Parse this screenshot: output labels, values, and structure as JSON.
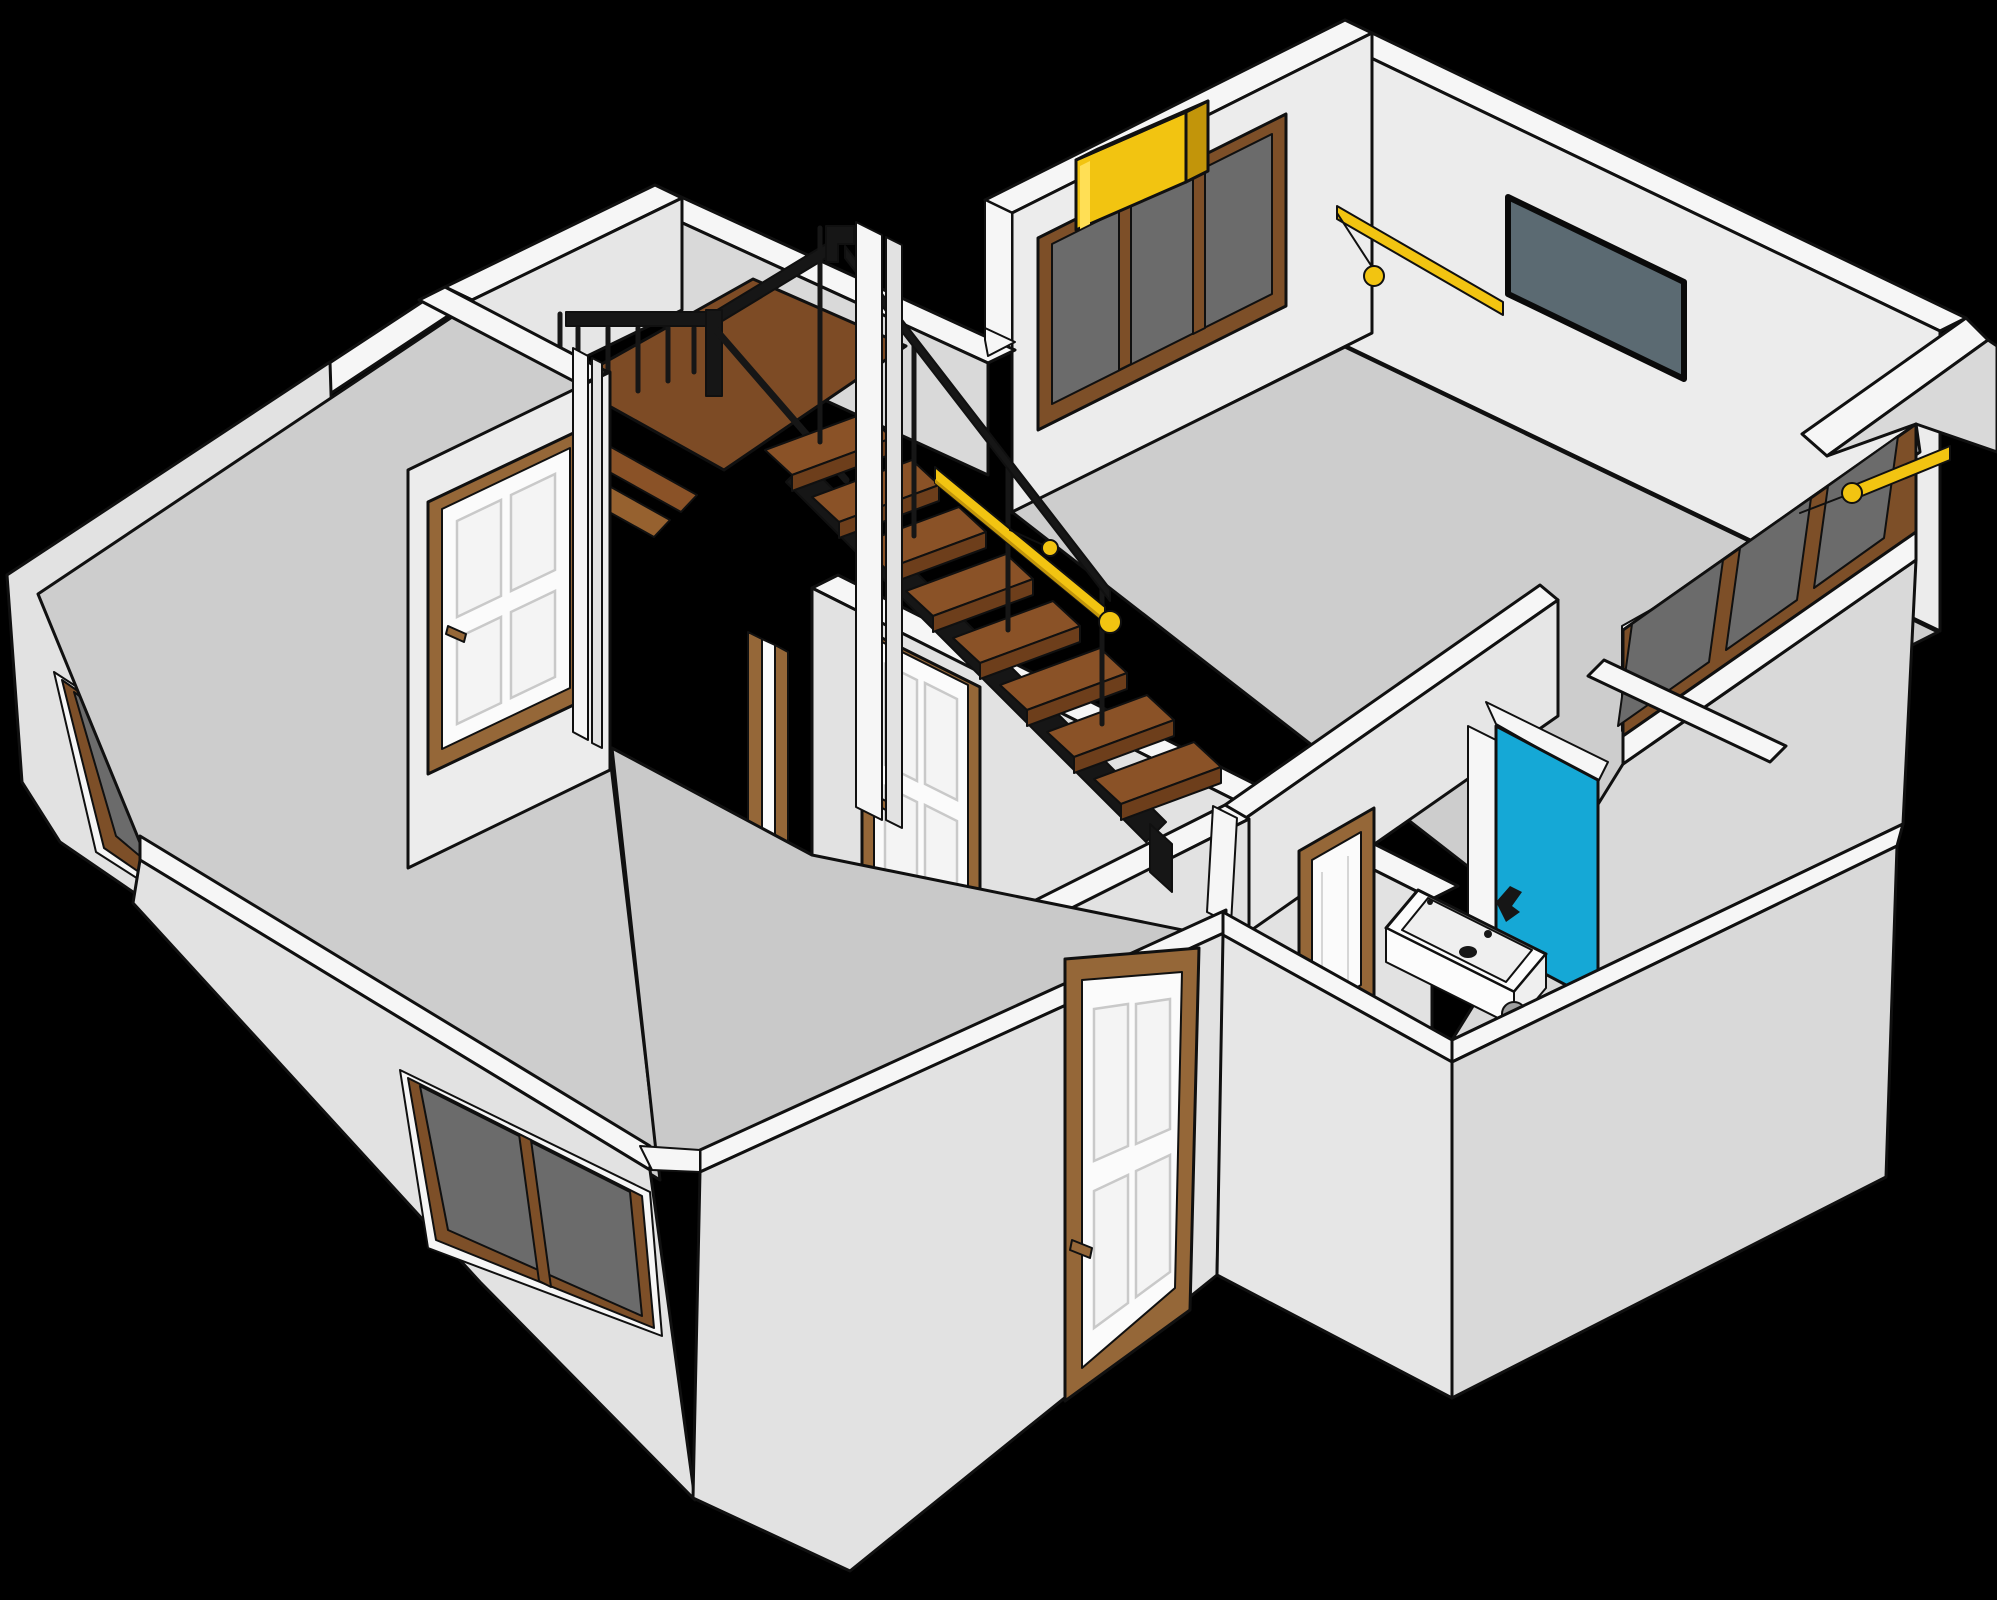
{
  "scene": {
    "title": "Isometric 3D cutaway floor plan of a single-storey house interior on a black background",
    "type": "vector-illustration",
    "background": "#000000"
  },
  "palette": {
    "wall_top": "#f6f6f6",
    "wall_face_light": "#ececec",
    "wall_face_mid": "#e2e2e2",
    "wall_face_dark": "#d9d9d9",
    "floor": "#cdcdcd",
    "outline": "#101010",
    "wood_landing": "#7d4b25",
    "wood_tread": "#8a5227",
    "wood_dark": "#6d3e1b",
    "door_frame_brown": "#956738",
    "door_leaf_white": "#fbfbfb",
    "window_frame_brown": "#7d4f28",
    "window_glass_gray": "#6b6b6b",
    "railing_black": "#161616",
    "accent_yellow": "#f2c411",
    "accent_yellow_dark": "#c2950a",
    "tv_screen": "#5b6a72",
    "shower_cyan": "#15a8d6",
    "sink_white": "#fcfcfc",
    "pipe_gray": "#9f9f9f"
  },
  "rooms": [
    {
      "name": "living-room",
      "position": "top-right",
      "fixtures": [
        "triple-pane window",
        "yellow AC unit",
        "wall TV",
        "yellow curtain rod with pull ring"
      ]
    },
    {
      "name": "landing-room",
      "position": "top-left",
      "fixtures": [
        "wood mezzanine landing",
        "black metal balustrade"
      ]
    },
    {
      "name": "stairwell",
      "position": "center",
      "fixtures": [
        "wood staircase",
        "black stringer",
        "yellow stair handrail"
      ]
    },
    {
      "name": "bedroom",
      "position": "left",
      "fixtures": [
        "white panel door",
        "two brown-framed exterior windows"
      ]
    },
    {
      "name": "lower-room",
      "position": "bottom-center",
      "fixtures": [
        "hall panel door",
        "exterior panel door"
      ]
    },
    {
      "name": "bathroom",
      "position": "center-right",
      "fixtures": [
        "cyan shower panel",
        "white washbasin with black faucet",
        "gray drain pipe",
        "bathroom door"
      ]
    },
    {
      "name": "corridor",
      "position": "right",
      "fixtures": [
        "angled window band",
        "yellow curtain rod",
        "white corridor door"
      ]
    }
  ],
  "counts": {
    "stair_treads": 8,
    "living_room_window_panes": 3,
    "right_window_band_panes": 3,
    "white_panel_doors": 5,
    "yellow_elements": 5
  }
}
